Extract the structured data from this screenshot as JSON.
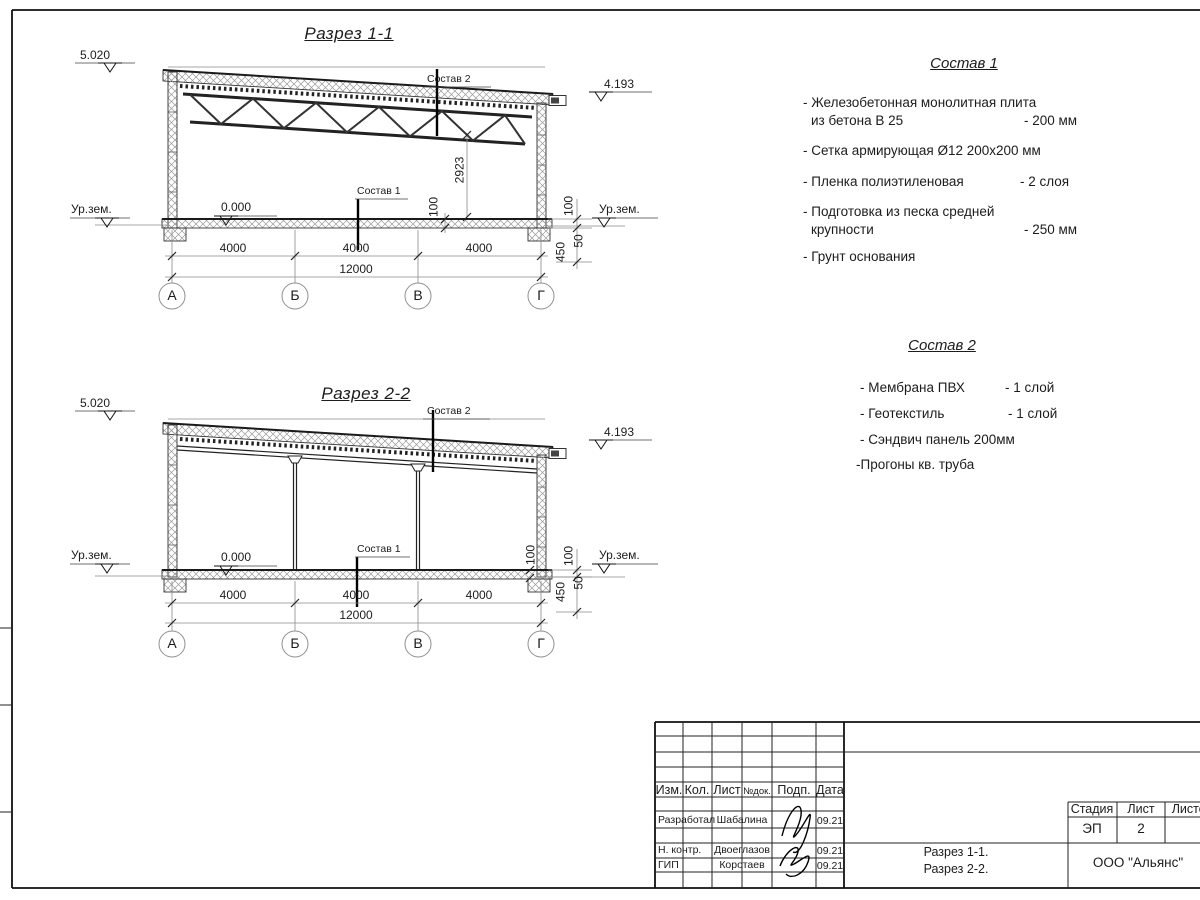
{
  "sheet": {
    "sections": [
      {
        "title": "Разрез 1-1",
        "elev_left": "5.020",
        "elev_right": "4.193",
        "elev_floor": "0.000",
        "ground_left": "Ур.зем.",
        "ground_right": "Ур.зем.",
        "leader_roof": "Состав 2",
        "leader_floor": "Состав 1",
        "dim_height": "2923",
        "dim_floor": "100",
        "dim_right_top": "100",
        "dim_right_mid": "50",
        "dim_right_bot": "450",
        "dim_spans": [
          "4000",
          "4000",
          "4000"
        ],
        "dim_total": "12000",
        "axes": [
          "А",
          "Б",
          "В",
          "Г"
        ]
      },
      {
        "title": "Разрез 2-2",
        "elev_left": "5.020",
        "elev_right": "4.193",
        "elev_floor": "0.000",
        "ground_left": "Ур.зем.",
        "ground_right": "Ур.зем.",
        "leader_roof": "Состав 2",
        "leader_floor": "Состав 1",
        "dim_floor": "100",
        "dim_right_top": "100",
        "dim_right_mid": "50",
        "dim_right_bot": "450",
        "dim_spans": [
          "4000",
          "4000",
          "4000"
        ],
        "dim_total": "12000",
        "axes": [
          "А",
          "Б",
          "В",
          "Г"
        ]
      }
    ],
    "sostav1": {
      "title": "Состав 1",
      "items": [
        {
          "l1": "- Железобетонная  монолитная плита",
          "l2": "из бетона В 25",
          "v": "- 200 мм"
        },
        {
          "l1": "- Сетка армирующая Ø12 200x200 мм"
        },
        {
          "l1": "- Пленка полиэтиленовая",
          "v": "-  2 слоя"
        },
        {
          "l1": "- Подготовка из песка средней",
          "l2": "крупности",
          "v": "- 250 мм"
        },
        {
          "l1": "- Грунт основания"
        }
      ]
    },
    "sostav2": {
      "title": "Состав 2",
      "items": [
        {
          "l1": "- Мембрана ПВХ",
          "v": "- 1 слой"
        },
        {
          "l1": "- Геотекстиль",
          "v": "- 1 слой"
        },
        {
          "l1": "- Сэндвич панель 200мм"
        },
        {
          "l1": "-Прогоны кв. труба"
        }
      ]
    }
  },
  "titleblock": {
    "cols": [
      "Изм.",
      "Кол.",
      "Лист",
      "№док.",
      "Подп.",
      "Дата"
    ],
    "rows": [
      {
        "role": "Разработал",
        "name": "Шабалина",
        "date": "09.21"
      },
      {
        "role": "Н. контр.",
        "name": "Двоеглазов",
        "date": "09.21"
      },
      {
        "role": "ГИП",
        "name": "Коротаев",
        "date": "09.21"
      }
    ],
    "stage_label": "Стадия",
    "sheet_label": "Лист",
    "sheets_label": "Листов",
    "stage": "ЭП",
    "sheet_no": "2",
    "doc_line1": "Разрез 1-1.",
    "doc_line2": "Разрез 2-2.",
    "company": "ООО \"Альянс\""
  }
}
